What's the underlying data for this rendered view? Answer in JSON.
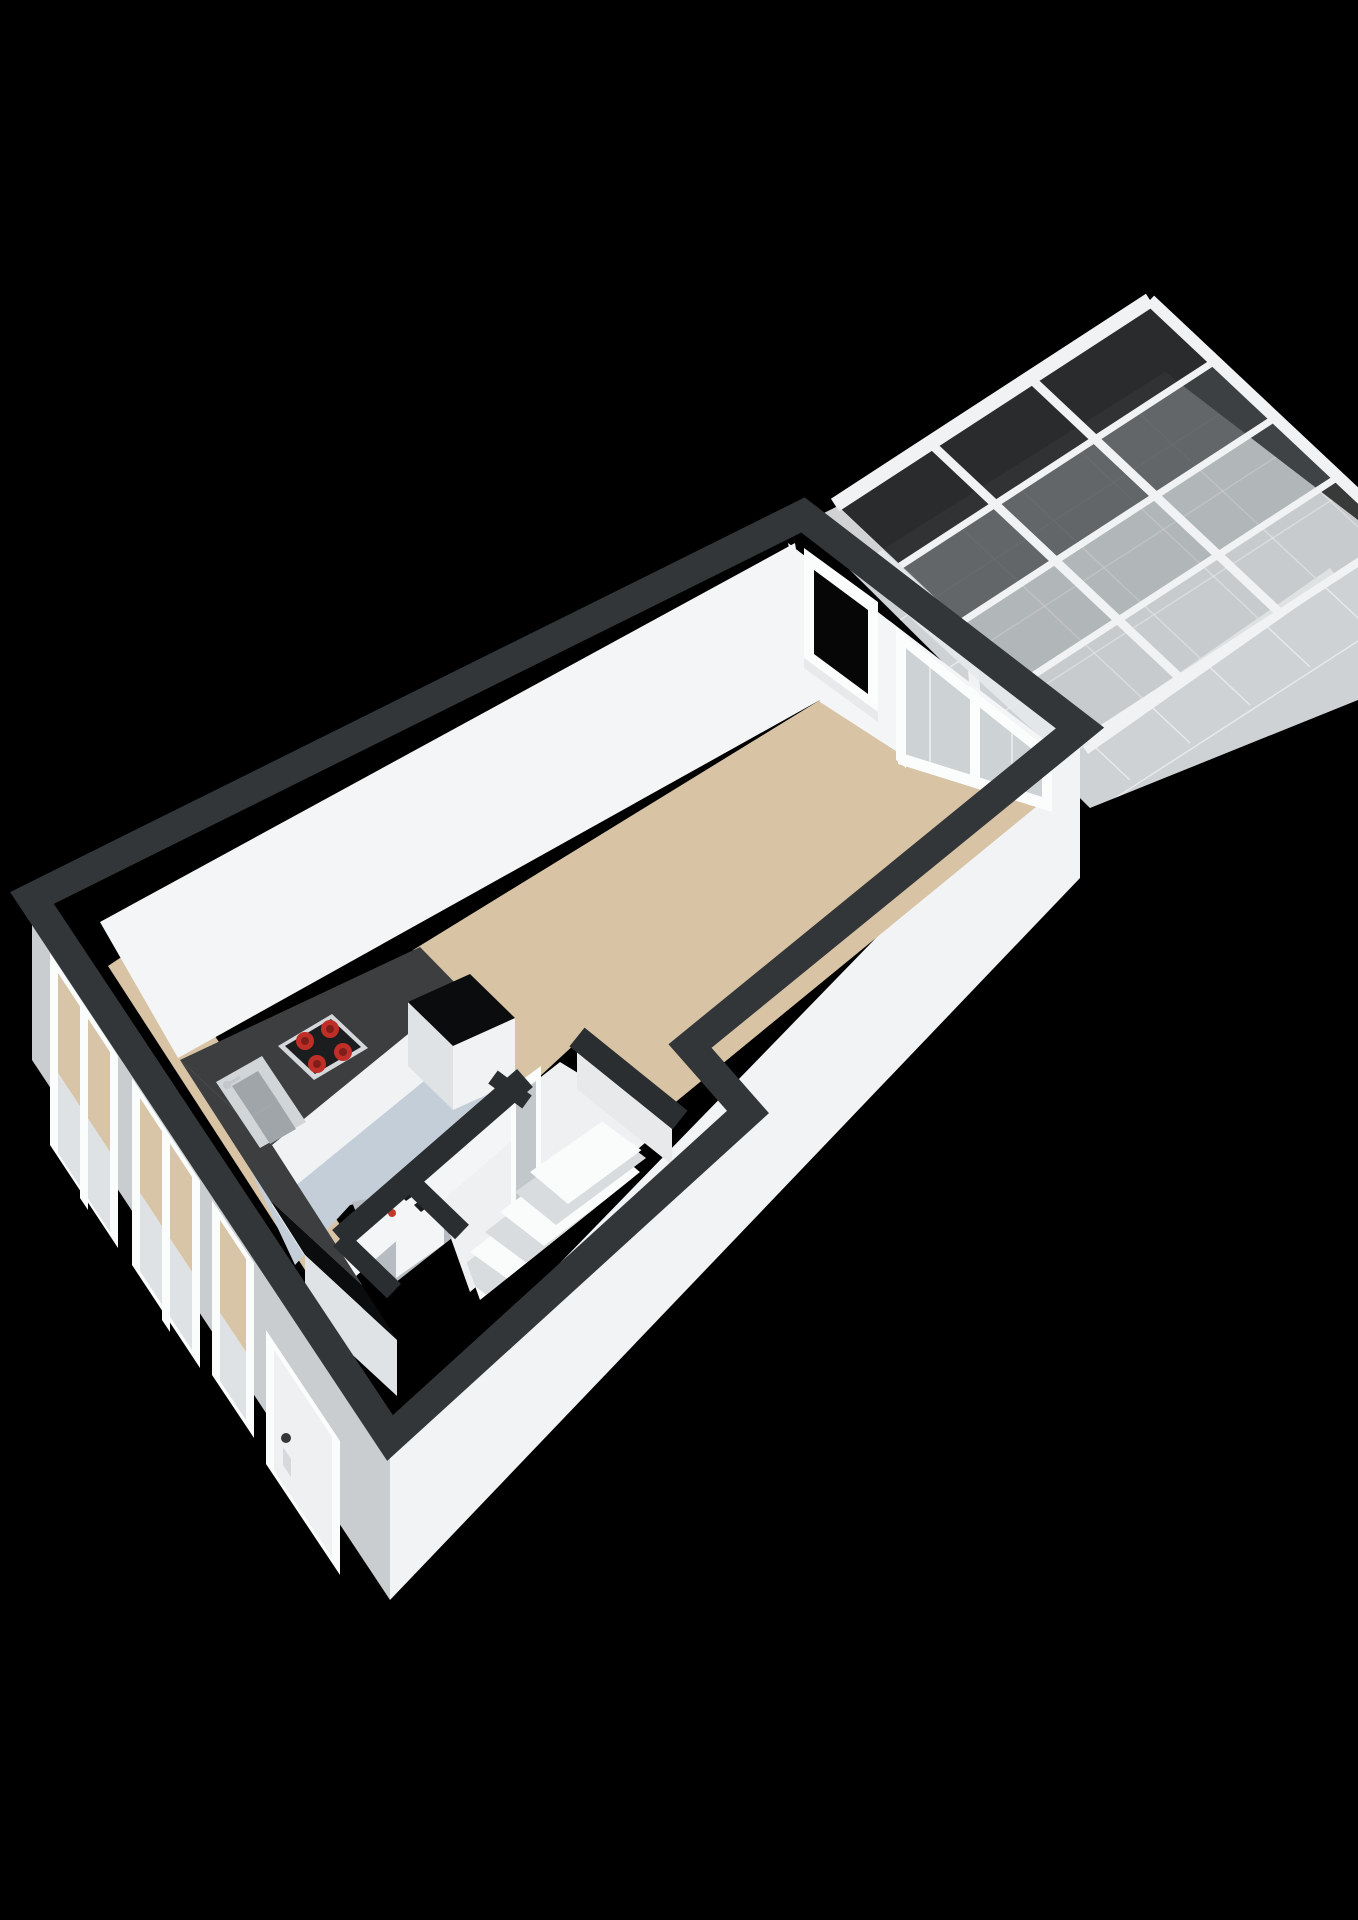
{
  "scene": {
    "type": "3d-floorplan-render",
    "rooms": 4,
    "burner_count": 4,
    "roof_panel_rows": 4,
    "facade_windows": 3,
    "stair_steps": 5
  },
  "colors": {
    "bg": "#000000",
    "wall_top": "#333638",
    "wall_top_inner": "#2b2e30",
    "wall_interior": "#f4f5f6",
    "wall_interior_shade": "#e7e9eb",
    "wall_exterior_gray": "#c9cdd0",
    "wall_exterior_gray_lt": "#d6d9db",
    "wall_exterior_white": "#f2f3f4",
    "floor_living": "#d8c3a5",
    "floor_kitchen": "#c4ced9",
    "floor_corridor": "#eef0f1",
    "floor_closet": "#b6bcc1",
    "floor_tiles": "#ced2d4",
    "tile_line": "#ffffff",
    "counter_top": "#3c3e40",
    "counter_cap": "#0b0c0d",
    "cabinet_face": "#f1f2f4",
    "cabinet_face_shade": "#e0e3e5",
    "cooktop_rim": "#d5d8da",
    "cooktop_panel": "#1b1d1f",
    "burner": "#bf2e27",
    "burner_core": "#7e1d19",
    "sink_steel": "#d2d5d7",
    "sink_basin": "#9fa5a9",
    "beam_white": "#f0f2f3",
    "roof_panel_1": "#2a2c2e",
    "roof_panel_2": "#4b4e50",
    "roof_panel_3": "#8f9498",
    "roof_panel_4": "#b8bcbe",
    "glass_dark": "#060606",
    "glass_light": "#cdd2d5",
    "glass_beige": "#d8c5a8",
    "glass_lower": "#dfe2e4",
    "door_leaf": "#eef0f1",
    "door_gray": "#c2c7cb",
    "stairs_light": "#fafbfb",
    "stairs_shade": "#d9dcde",
    "heater_body": "#f4f5f6",
    "heater_mark": "#1a1b1c",
    "heater_red": "#c0392b",
    "frame_white": "#fbfcfc"
  }
}
